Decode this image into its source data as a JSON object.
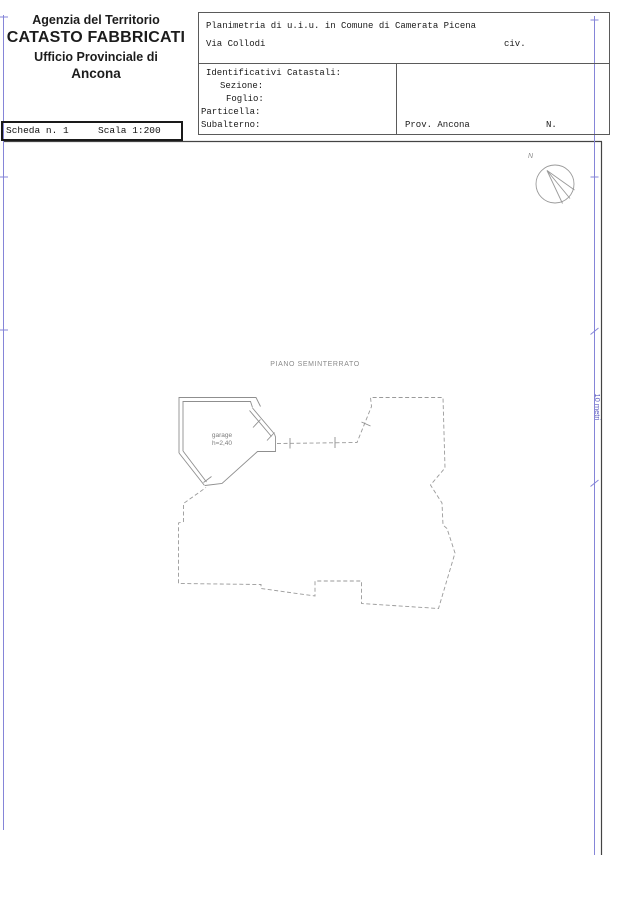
{
  "agency": {
    "line1": "Agenzia del Territorio",
    "line2": "CATASTO FABBRICATI",
    "line3": "Ufficio Provinciale di",
    "line4": "Ancona"
  },
  "sheet": {
    "scheda": "Scheda n. 1",
    "scala": "Scala 1:200"
  },
  "form": {
    "title": "Planimetria di u.i.u. in Comune di Camerata Picena",
    "street": "Via Collodi",
    "civ": "civ.",
    "section_title": "Identificativi Catastali:",
    "fields": {
      "sezione": "Sezione:",
      "foglio": "Foglio:",
      "particella": "Particella:",
      "subalterno": "Subalterno:"
    },
    "prov": "Prov. Ancona",
    "n": "N."
  },
  "plan": {
    "floor_label": "PIANO SEMINTERRATO",
    "room_label": "garage",
    "room_height": "h=2,40",
    "compass": "N",
    "dimension_label": "10 metri"
  },
  "colors": {
    "dimension_blue": "#8585d8",
    "plan_line_gray": "#9a9a9a",
    "frame_dark": "#444444"
  }
}
